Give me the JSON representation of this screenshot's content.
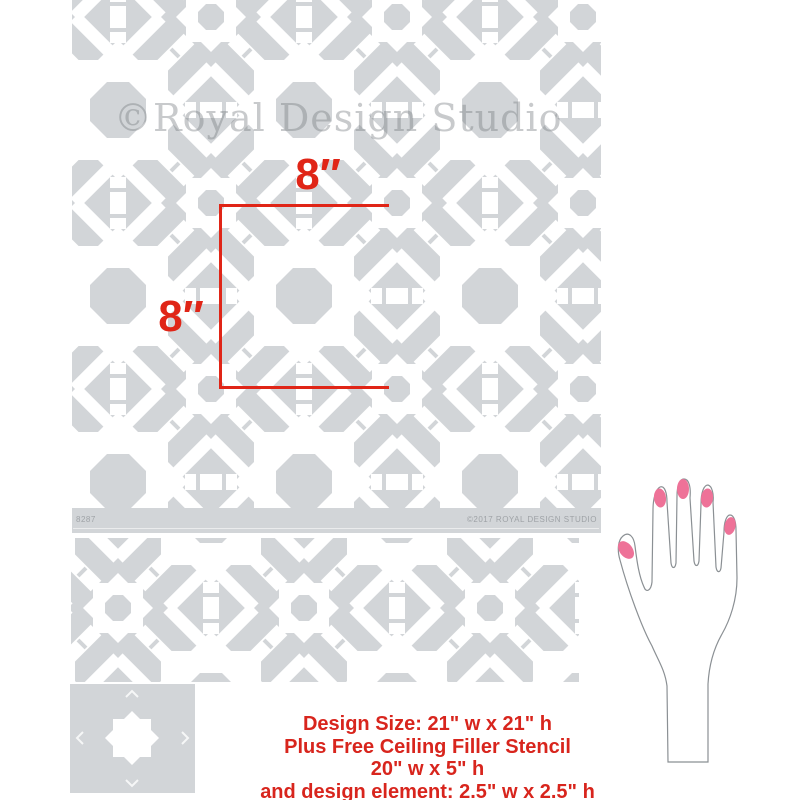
{
  "image_type": "stencil-product-diagram",
  "watermark": {
    "text": "©Royal Design Studio"
  },
  "main_stencil": {
    "sku": "8287",
    "copyright": "©2017 ROYAL DESIGN STUDIO",
    "sheet_color": "#d2d5d8",
    "cutout_color": "#ffffff",
    "pattern": "interlocking Moroccan star weave"
  },
  "border_stencil": {
    "sheet_color": "#d2d5d8",
    "pattern": "woven ribbon ceiling filler band"
  },
  "element_stencil": {
    "sheet_color": "#d2d5d8",
    "motif": "8-pointed star"
  },
  "dimensions": {
    "width_label": "8″",
    "height_label": "8″",
    "accent_color": "#e02517"
  },
  "caption": {
    "line1": "Design Size: 21\" w x 21\" h",
    "line2": "Plus Free Ceiling Filler Stencil",
    "line3": "20\" w x 5\" h",
    "line4": "and design element: 2.5\" w x 2.5\" h",
    "color": "#d8251d"
  },
  "hand": {
    "nail_color": "#ee7298",
    "outline_color": "#8b9094"
  }
}
